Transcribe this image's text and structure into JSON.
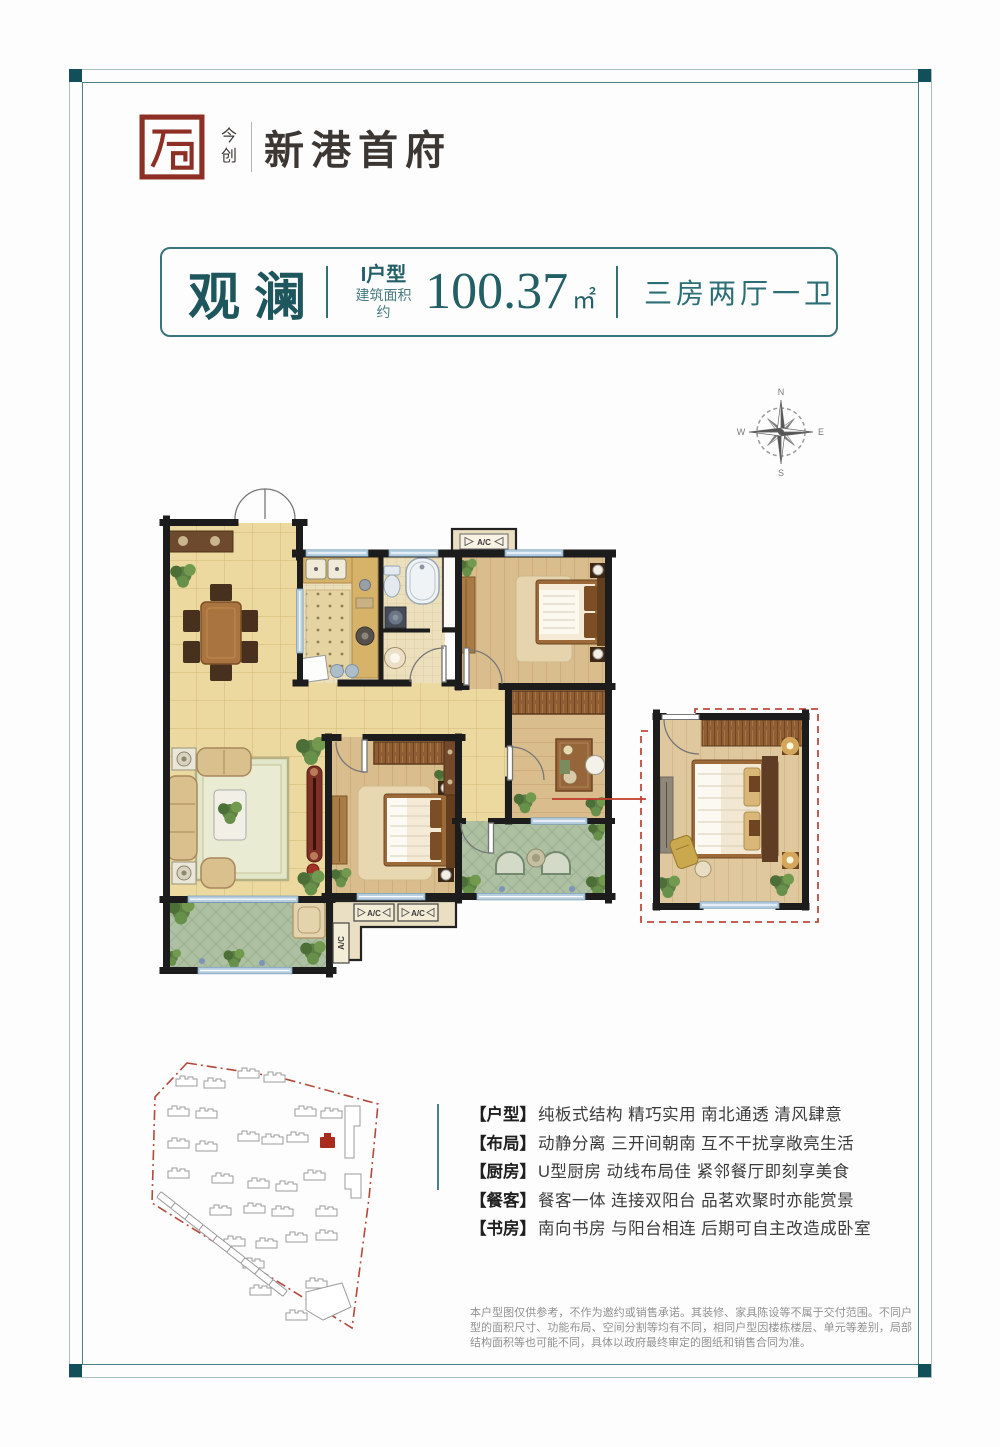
{
  "brand": {
    "sub": "今创",
    "name": "新港首府"
  },
  "title_bar": {
    "name": "观澜",
    "unit_label": "I户型",
    "area_prefix": "建筑面积约",
    "area_value": "100.37",
    "area_unit": "㎡",
    "rooms": "三房两厅一卫"
  },
  "compass": {
    "n": "N",
    "e": "E",
    "s": "S",
    "w": "W"
  },
  "plan": {
    "ac_label": "A/C"
  },
  "features": [
    {
      "label": "【户型】",
      "text": "纯板式结构  精巧实用  南北通透  清风肆意"
    },
    {
      "label": "【布局】",
      "text": "动静分离  三开间朝南  互不干扰享敞亮生活"
    },
    {
      "label": "【厨房】",
      "text": "U型厨房  动线布局佳  紧邻餐厅即刻享美食"
    },
    {
      "label": "【餐客】",
      "text": "餐客一体  连接双阳台  品茗欢聚时亦能赏景"
    },
    {
      "label": "【书房】",
      "text": "南向书房  与阳台相连  后期可自主改造成卧室"
    }
  ],
  "disclaimer": "本户型图仅供参考，不作为邀约或销售承诺。其装修、家具陈设等不属于交付范围。不同户型的面积尺寸、功能布局、空间分割等均有不同，相同户型因楼栋楼层、单元等差别，局部结构面积等也可能不同，具体以政府最终审定的图纸和销售合同为准。",
  "colors": {
    "accent": "#2a6f76",
    "seal_red": "#8e2f26",
    "wall": "#1c1c1c",
    "balcony_green": "#adc0a2",
    "site_boundary": "#b2493c",
    "highlight_building": "#a92b1d"
  }
}
